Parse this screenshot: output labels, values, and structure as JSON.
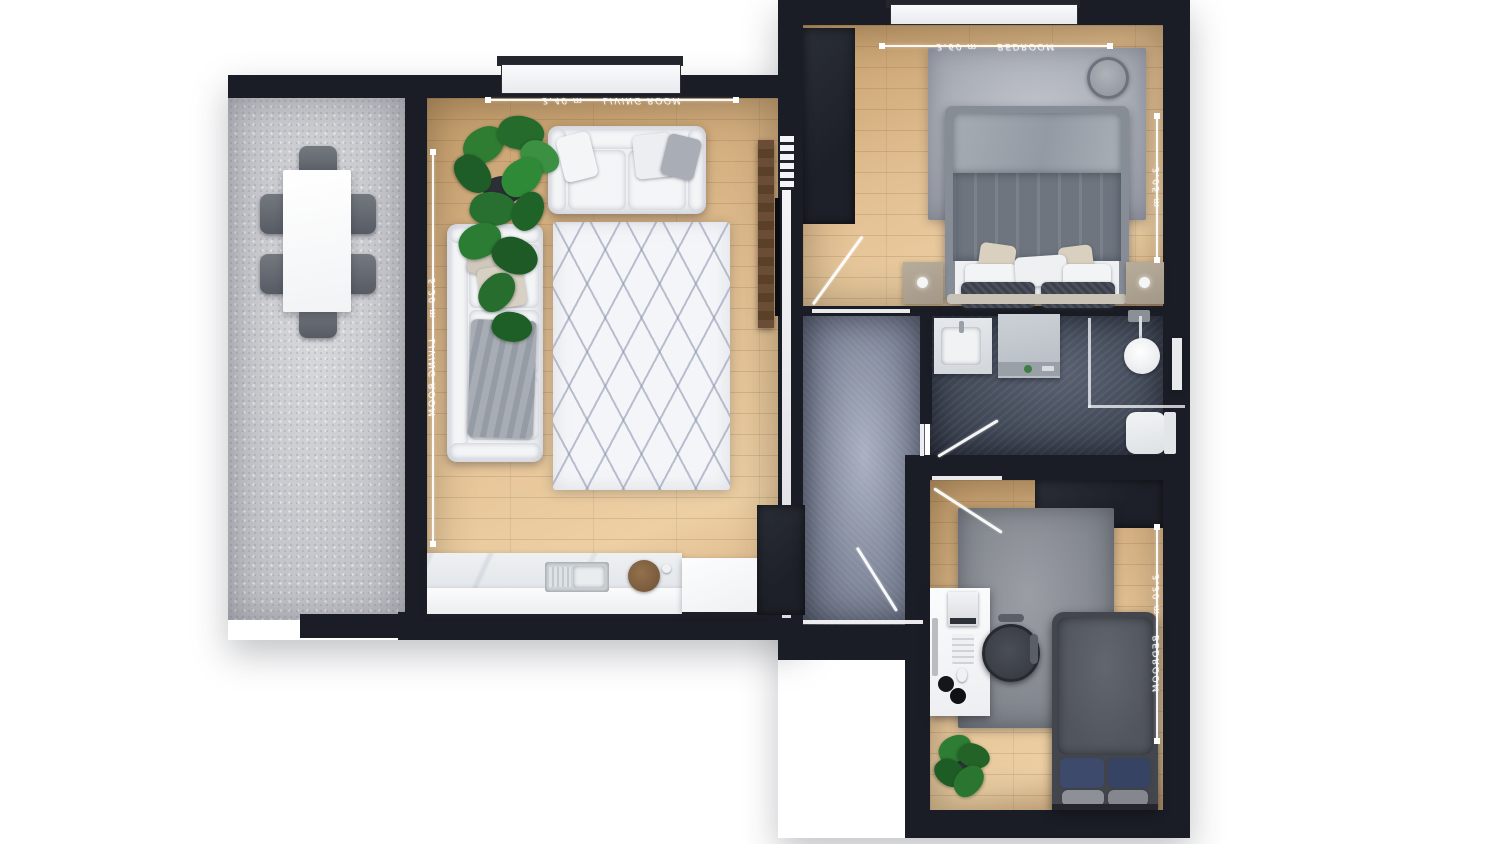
{
  "scene": {
    "title": "apartment-floor-plan-3d-top-view",
    "background_color": "#ffffff",
    "label_style": "mirrored-script dimension annotations"
  },
  "palette": {
    "walls": "#1a1d25",
    "wood_floor": "#ddb98c",
    "terrace_floor": "#c6c7cc",
    "hallway_floor": "#828a9d",
    "bathroom_floor": "#434a59",
    "furniture_white": "#f2f3f5",
    "plant_green": "#2e7d32",
    "pillow_blue": "#3d4a6b",
    "dimension_line": "#ffffff"
  },
  "rooms": [
    {
      "id": "terrace",
      "name": "Terrace",
      "furniture": [
        "dining-table",
        "dining-chair x6"
      ]
    },
    {
      "id": "living-room",
      "name": "Living Room + Kitchen",
      "furniture": [
        "loveseat-sofa",
        "three-seat-sofa",
        "diamond-pattern-rug",
        "potted-plant",
        "tv-sideboard",
        "tv",
        "radiator",
        "kitchen-counter",
        "kitchen-sink",
        "cutting-board",
        "wardrobe"
      ]
    },
    {
      "id": "hallway",
      "name": "Hallway",
      "furniture": [
        "entry-door"
      ]
    },
    {
      "id": "bedroom-main",
      "name": "Main Bedroom",
      "furniture": [
        "double-bed",
        "nightstand x2",
        "lamp x2",
        "rug",
        "wardrobe",
        "wall-clock"
      ]
    },
    {
      "id": "bathroom",
      "name": "Bathroom",
      "furniture": [
        "sink-vanity",
        "washing-machine",
        "shower-enclosure",
        "toilet"
      ]
    },
    {
      "id": "bedroom-second",
      "name": "Second Bedroom / Office",
      "furniture": [
        "single-bed",
        "desk",
        "office-chair",
        "printer",
        "keyboard",
        "mouse",
        "headphones",
        "rug",
        "wardrobe",
        "potted-plant"
      ]
    }
  ],
  "dimension_lines": [
    {
      "id": "living-top",
      "orientation": "horizontal",
      "label": "3.40 m — LIVING ROOM"
    },
    {
      "id": "living-left",
      "orientation": "vertical",
      "label": "5.20 m — LIVING ROOM"
    },
    {
      "id": "bedroom-main-top",
      "orientation": "horizontal",
      "label": "3.60 m — BEDROOM"
    },
    {
      "id": "bedroom-main-right",
      "orientation": "vertical",
      "label": "3.05 m"
    },
    {
      "id": "bedroom-second-right",
      "orientation": "vertical",
      "label": "3.30 m — BEDROOM"
    }
  ]
}
